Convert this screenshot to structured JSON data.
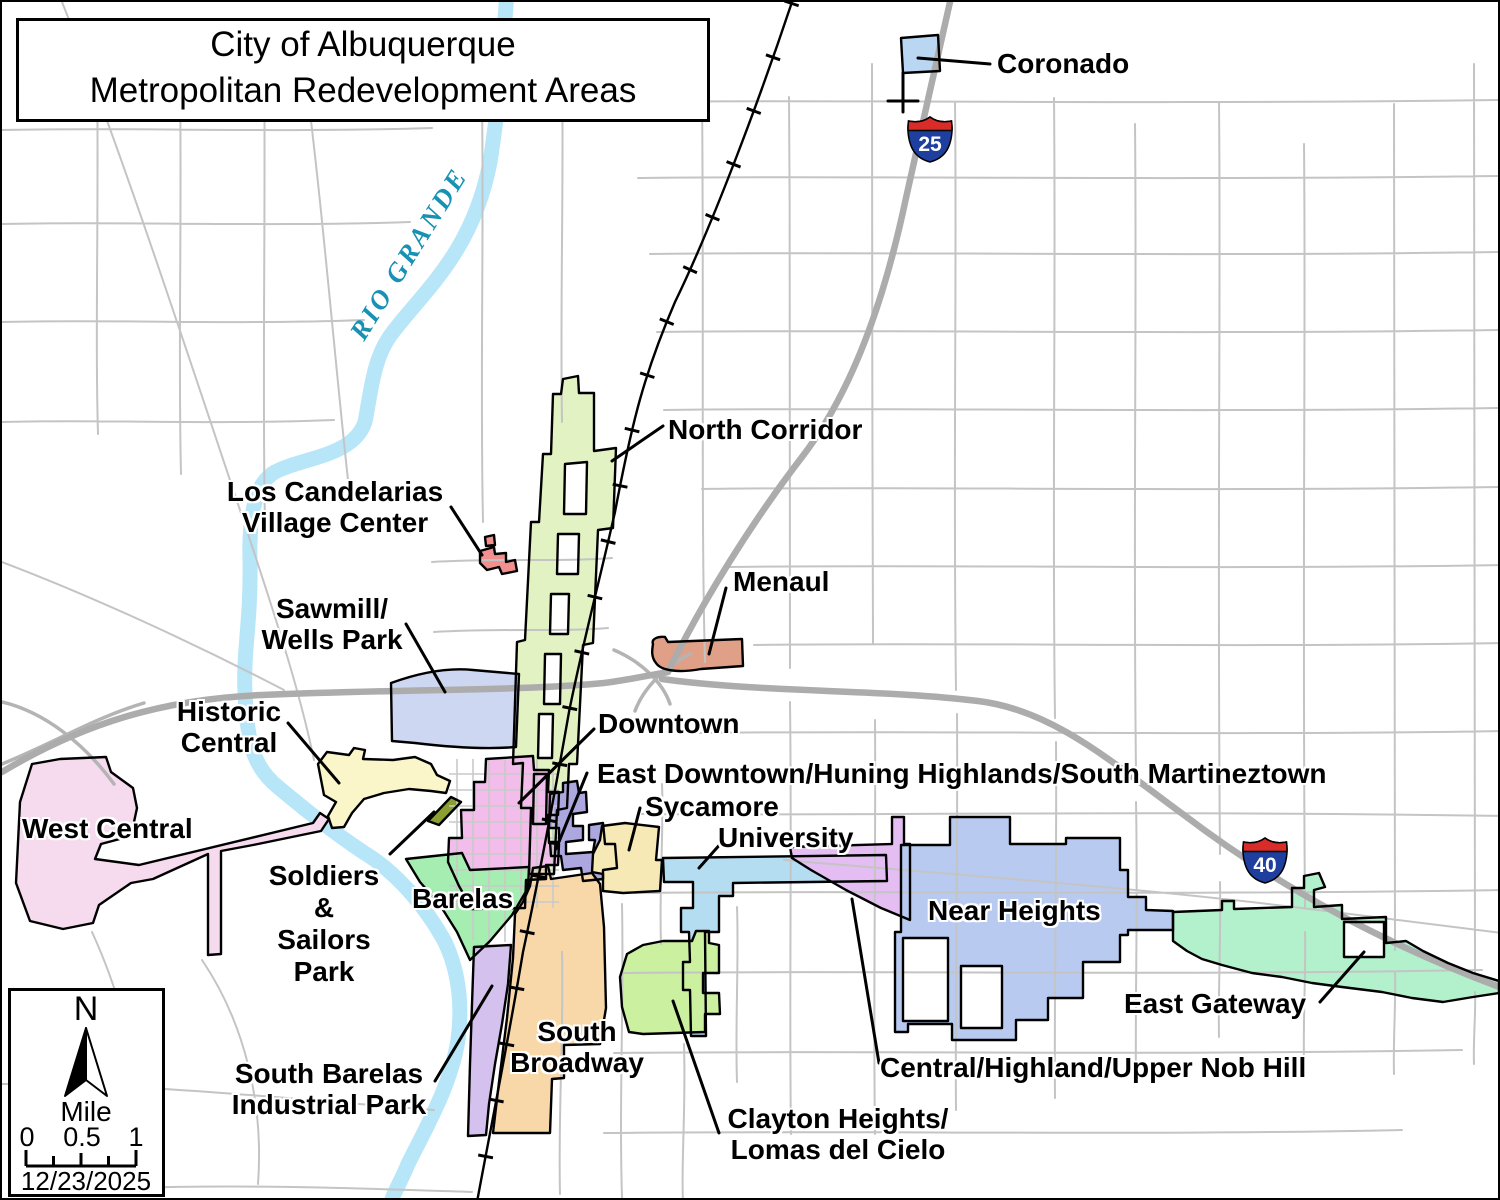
{
  "title": "City of Albuquerque\nMetropolitan Redevelopment Areas",
  "river_label": "RIO GRANDE",
  "colors": {
    "river": "#b7e6f8",
    "river_text": "#1791b4",
    "shield_red": "#d92b27",
    "shield_blue": "#1f3f9f"
  },
  "shields": [
    {
      "route": "25"
    },
    {
      "route": "40"
    }
  ],
  "legend": {
    "north": "N",
    "unit": "Mile",
    "ticks": [
      "0",
      "0.5",
      "1"
    ],
    "date": "12/23/2025"
  },
  "regions": [
    {
      "id": "coronado",
      "label": "Coronado",
      "color": "#b9d7f2"
    },
    {
      "id": "north-corridor",
      "label": "North Corridor",
      "color": "#e3f2c3"
    },
    {
      "id": "los-candelarias",
      "label": "Los Candelarias\nVillage Center",
      "color": "#f29090"
    },
    {
      "id": "menaul",
      "label": "Menaul",
      "color": "#e0a088"
    },
    {
      "id": "sawmill-wells-park",
      "label": "Sawmill/\nWells Park",
      "color": "#cdd7f2"
    },
    {
      "id": "historic-central",
      "label": "Historic\nCentral",
      "color": "#faf6c9"
    },
    {
      "id": "west-central",
      "label": "West Central",
      "color": "#f6daee"
    },
    {
      "id": "soldiers-sailors-park",
      "label": "Soldiers\n&\nSailors\nPark",
      "color": "#8a9e33"
    },
    {
      "id": "downtown",
      "label": "Downtown",
      "color": "#f2bdea"
    },
    {
      "id": "east-downtown",
      "label": "East Downtown/Huning Highlands/South Martineztown",
      "color": "#aca7df"
    },
    {
      "id": "sycamore",
      "label": "Sycamore",
      "color": "#f6e9b5"
    },
    {
      "id": "university",
      "label": "University",
      "color": "#b5ddf2"
    },
    {
      "id": "barelas",
      "label": "Barelas",
      "color": "#a6edb1"
    },
    {
      "id": "south-barelas",
      "label": "South Barelas\nIndustrial Park",
      "color": "#d5c1ed"
    },
    {
      "id": "south-broadway",
      "label": "South\nBroadway",
      "color": "#f8d8a9"
    },
    {
      "id": "clayton-heights",
      "label": "Clayton Heights/\nLomas del Cielo",
      "color": "#caf0a0"
    },
    {
      "id": "central-highland",
      "label": "Central/Highland/Upper Nob Hill",
      "color": "#e4bef2"
    },
    {
      "id": "near-heights",
      "label": "Near Heights",
      "color": "#b8caf0"
    },
    {
      "id": "east-gateway",
      "label": "East Gateway",
      "color": "#b3f0cc"
    }
  ]
}
